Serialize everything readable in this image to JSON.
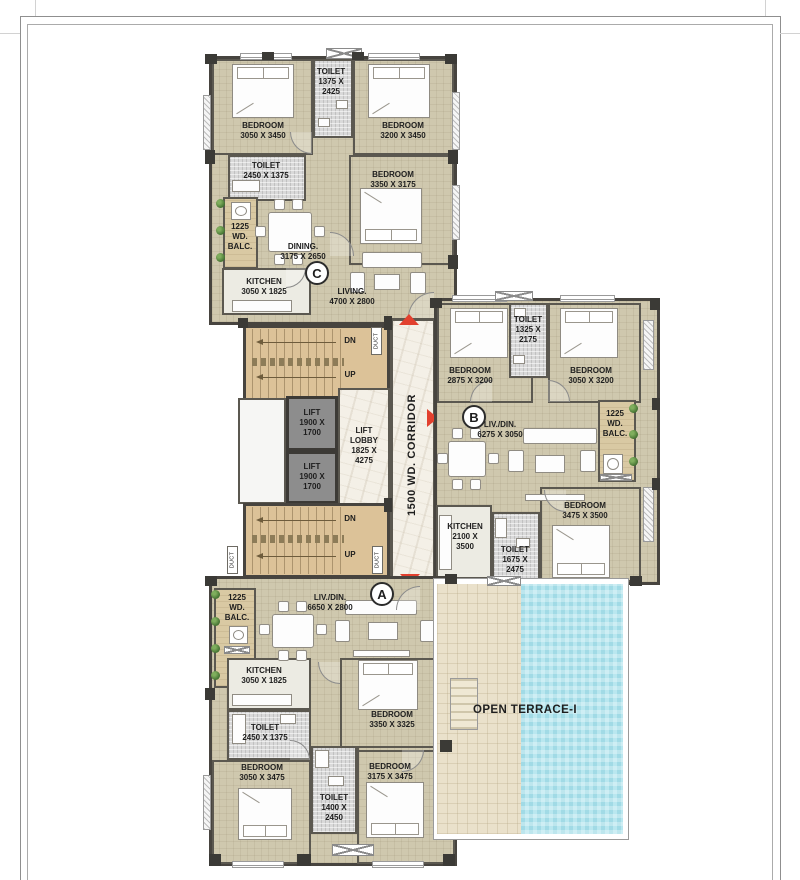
{
  "units": {
    "c": {
      "marker": "C",
      "bedroom_1": "BEDROOM\n3050 X 3450",
      "toilet_1": "TOILET\n1375 X\n2425",
      "bedroom_2": "BEDROOM\n3200 X 3450",
      "toilet_2": "TOILET\n2450 X 1375",
      "bedroom_3": "BEDROOM\n3350 X 3175",
      "balcony": "1225\nWD.\nBALC.",
      "dining": "DINING.\n3175 X 2650",
      "kitchen": "KITCHEN\n3050 X 1825",
      "living": "LIVING.\n4700 X 2800"
    },
    "b": {
      "marker": "B",
      "bedroom_1": "BEDROOM\n2875 X 3200",
      "toilet_1": "TOILET\n1325 X\n2175",
      "bedroom_2": "BEDROOM\n3050 X 3200",
      "living_dining": "LIV./DIN.\n6275 X 3050",
      "balcony": "1225\nWD.\nBALC.",
      "kitchen": "KITCHEN\n2100 X\n3500",
      "toilet_2": "TOILET\n1675 X\n2475",
      "bedroom_3": "BEDROOM\n3475 X 3500"
    },
    "a": {
      "marker": "A",
      "living_dining": "LIV./DIN.\n6650 X 2800",
      "balcony": "1225\nWD.\nBALC.",
      "kitchen": "KITCHEN\n3050 X 1825",
      "toilet_1": "TOILET\n2450 X 1375",
      "bedroom_1": "BEDROOM\n3350 X 3325",
      "bedroom_2": "BEDROOM\n3050 X 3475",
      "toilet_2": "TOILET\n1400 X\n2450",
      "bedroom_3": "BEDROOM\n3175 X 3475"
    }
  },
  "core": {
    "stairs_top": {
      "dn": "DN",
      "up": "UP"
    },
    "stairs_bottom": {
      "dn": "DN",
      "up": "UP"
    },
    "lift_1": "LIFT\n1900 X\n1700",
    "lift_2": "LIFT\n1900 X\n1700",
    "lift_lobby": "LIFT\nLOBBY\n1825 X\n4275",
    "corridor": "1500 WD. CORRIDOR",
    "duct": "DUCT"
  },
  "terrace": {
    "label": "OPEN TERRACE-I"
  },
  "colors": {
    "wall": "#47443f",
    "room_floor": "#cfc8ae",
    "balcony_floor": "#d9c9a3",
    "stair_floor": "#dcc298",
    "toilet_floor": "#d9d9d9",
    "marble_floor": "#f4f0e7",
    "terrace_floor": "#eae1cb",
    "pool_water": "#b9e7ef",
    "entry_arrow": "#e2402e",
    "plant_green": "#4c7c3c"
  }
}
